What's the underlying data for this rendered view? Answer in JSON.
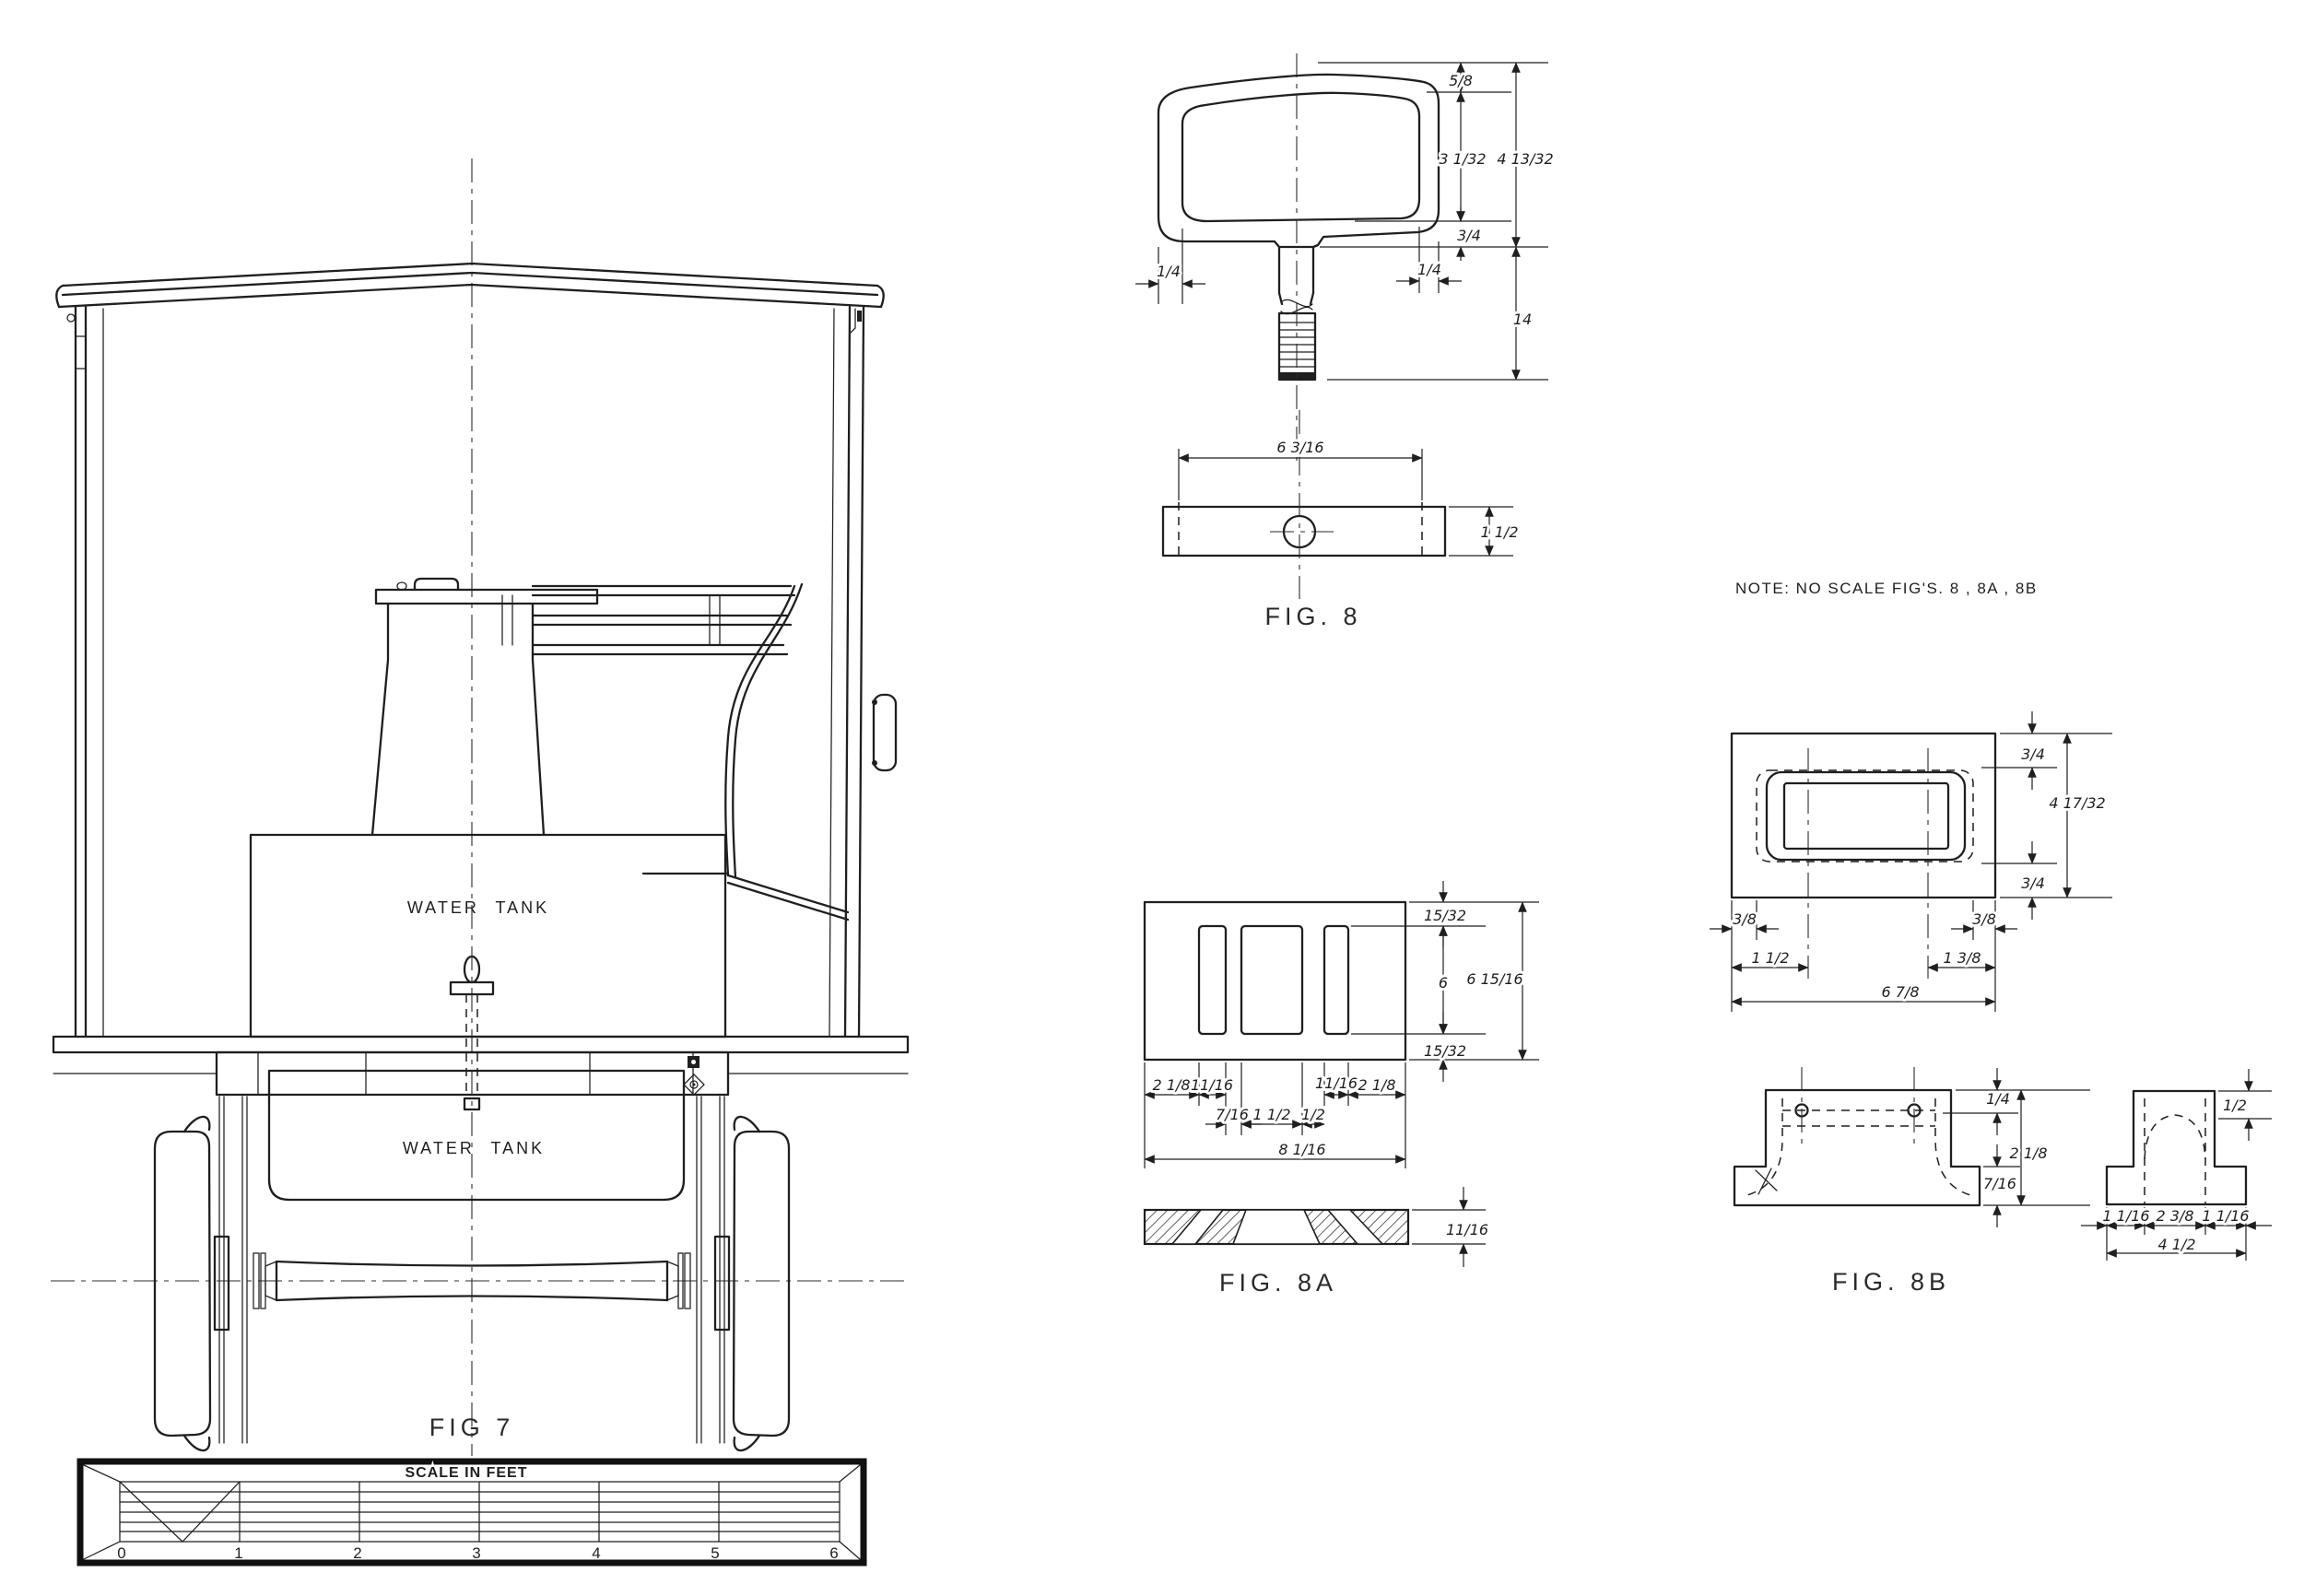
{
  "sheet": {
    "background": "#ffffff",
    "ink": "#1f1f1f"
  },
  "note": {
    "text": "NOTE:  NO SCALE FIG'S.  8 , 8A , 8B"
  },
  "fig7": {
    "label": "FIG 7",
    "upper_tank_label": "WATER TANK",
    "lower_tank_label": "WATER TANK",
    "scale_bar": {
      "title": "SCALE IN FEET",
      "unit_ticks": [
        "0",
        "1",
        "2",
        "3",
        "4",
        "5",
        "6"
      ]
    }
  },
  "fig8": {
    "label": "FIG. 8",
    "dims": {
      "head_top_offset": "5/8",
      "head_inner_height": "3 1/32",
      "head_overall_height": "4 13/32",
      "head_bottom_offset": "3/4",
      "side_left": "1/4",
      "side_right": "1/4",
      "stem_length": "14",
      "bar_length": "6 3/16",
      "bar_depth": "1 1/2"
    }
  },
  "fig8a": {
    "label": "FIG. 8A",
    "dims": {
      "top_margin": "15/32",
      "slot_height": "6",
      "overall_height": "6 15/16",
      "bottom_margin": "15/32",
      "left_margin": "2 1/8",
      "left_slot_width": "11/16",
      "web_left": "7/16",
      "center_slot_width": "1 1/2",
      "web_right": "1/2",
      "right_slot_width": "11/16",
      "right_margin": "2 1/8",
      "overall_width": "8 1/16",
      "thickness": "11/16"
    }
  },
  "fig8b": {
    "label": "FIG. 8B",
    "dims": {
      "plan_top_margin": "3/4",
      "plan_overall_height": "4 17/32",
      "plan_bottom_margin": "3/4",
      "plan_left_inset": "3/8",
      "plan_right_inset": "3/8",
      "plan_left_center": "1 1/2",
      "plan_right_center": "1 3/8",
      "plan_overall_width": "6 7/8",
      "elev_top_thickness": "1/4",
      "elev_overall_height": "2 1/8",
      "elev_base_height": "7/16",
      "sec_top_thickness": "1/2",
      "sec_left_width": "1 1/16",
      "sec_center_width": "2 3/8",
      "sec_right_width": "1 1/16",
      "sec_overall_width": "4 1/2"
    }
  }
}
